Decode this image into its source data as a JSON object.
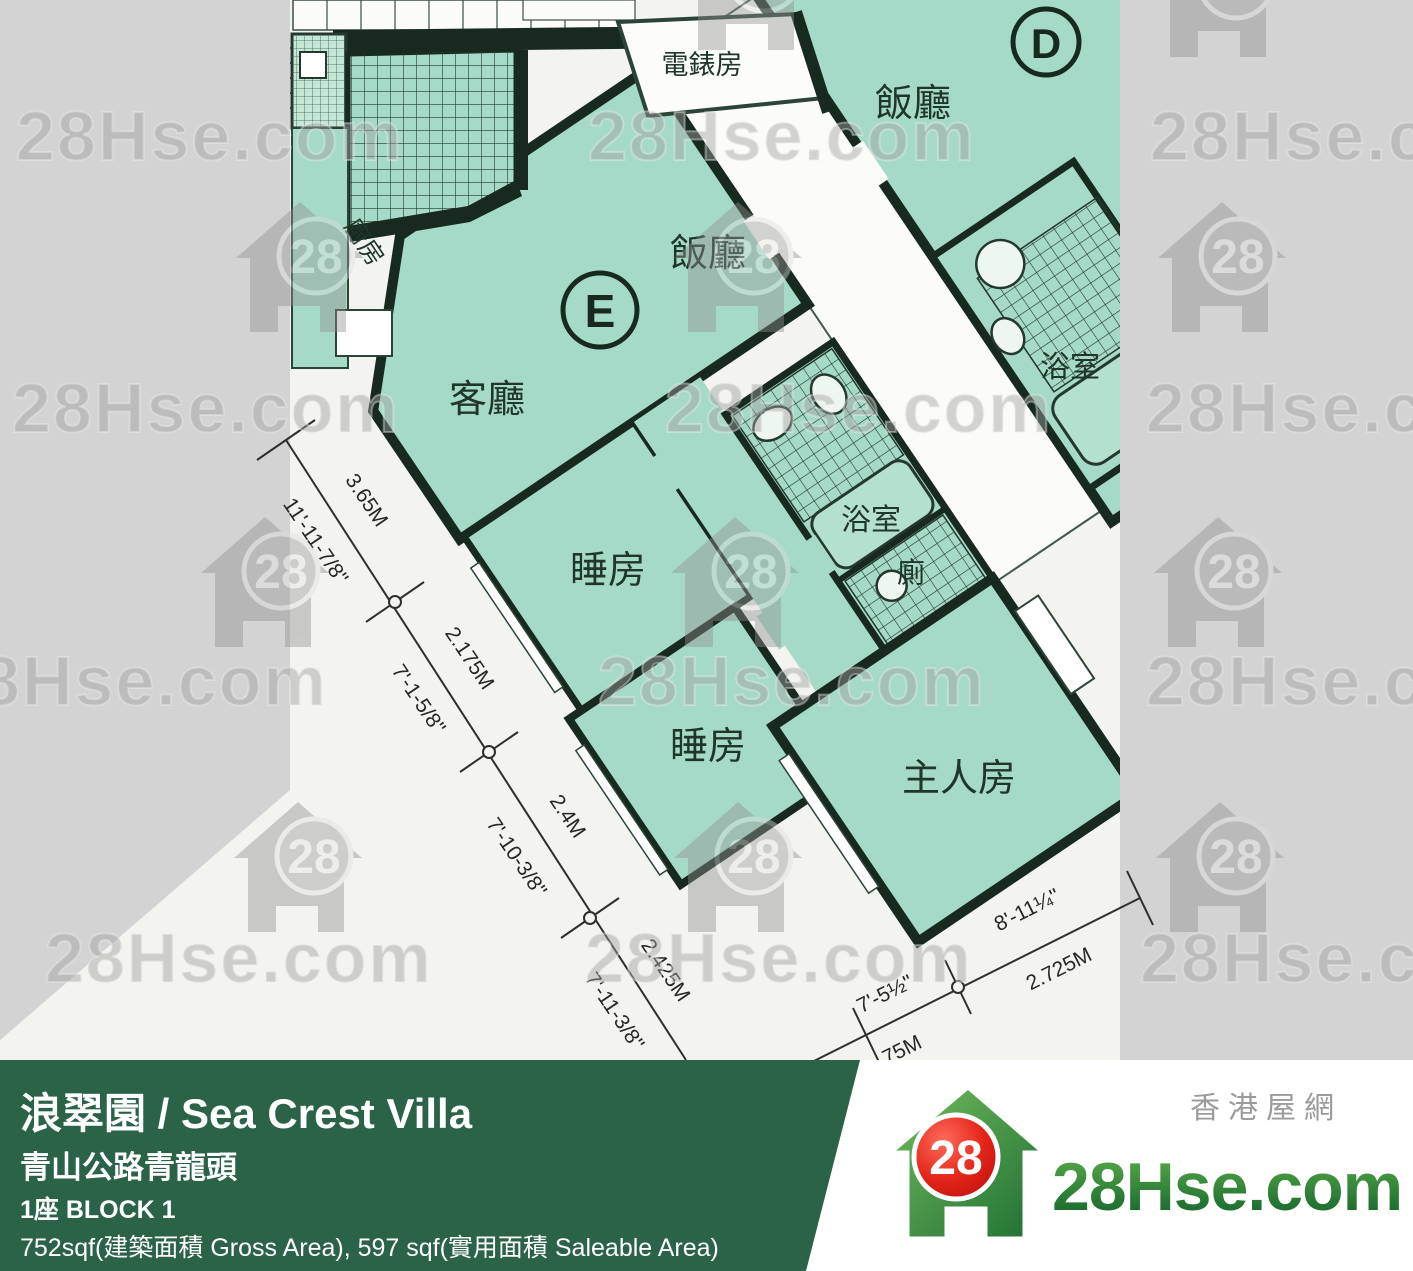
{
  "watermark": {
    "text": "28Hse.com",
    "badge": "28"
  },
  "plan": {
    "unit_d": "D",
    "unit_e": "E",
    "rooms": {
      "meter": "電錶房",
      "dining": "飯廳",
      "living": "客廳",
      "kitchen": "廚房",
      "bedroom": "睡房",
      "master": "主人房",
      "bath": "浴室",
      "toilet": "廁"
    }
  },
  "dimensions": {
    "left": [
      {
        "metric": "3.65M",
        "imperial": "11'-11-7/8''"
      },
      {
        "metric": "2.175M",
        "imperial": "7'-1-5/8''"
      },
      {
        "metric": "2.4M",
        "imperial": "7'-10-3/8''"
      },
      {
        "metric": "2.425M",
        "imperial": "7'-11-3/8''"
      }
    ],
    "bottom": [
      {
        "metric": "75M",
        "imperial": "7'-5½''"
      },
      {
        "metric": "2.725M",
        "imperial": "8'-11¼''"
      }
    ]
  },
  "banner": {
    "title": "浪翠園 / Sea Crest Villa",
    "address": "青山公路青龍頭",
    "block": "1座   BLOCK 1",
    "area": "752sqf(建築面積 Gross Area), 597 sqf(實用面積 Saleable Area)",
    "bg_color": "#2a6348"
  },
  "logo": {
    "badge": "28",
    "brand": "28Hse.com",
    "cjk": "香港屋網",
    "green": "#1d6e33",
    "red": "#d51414"
  }
}
